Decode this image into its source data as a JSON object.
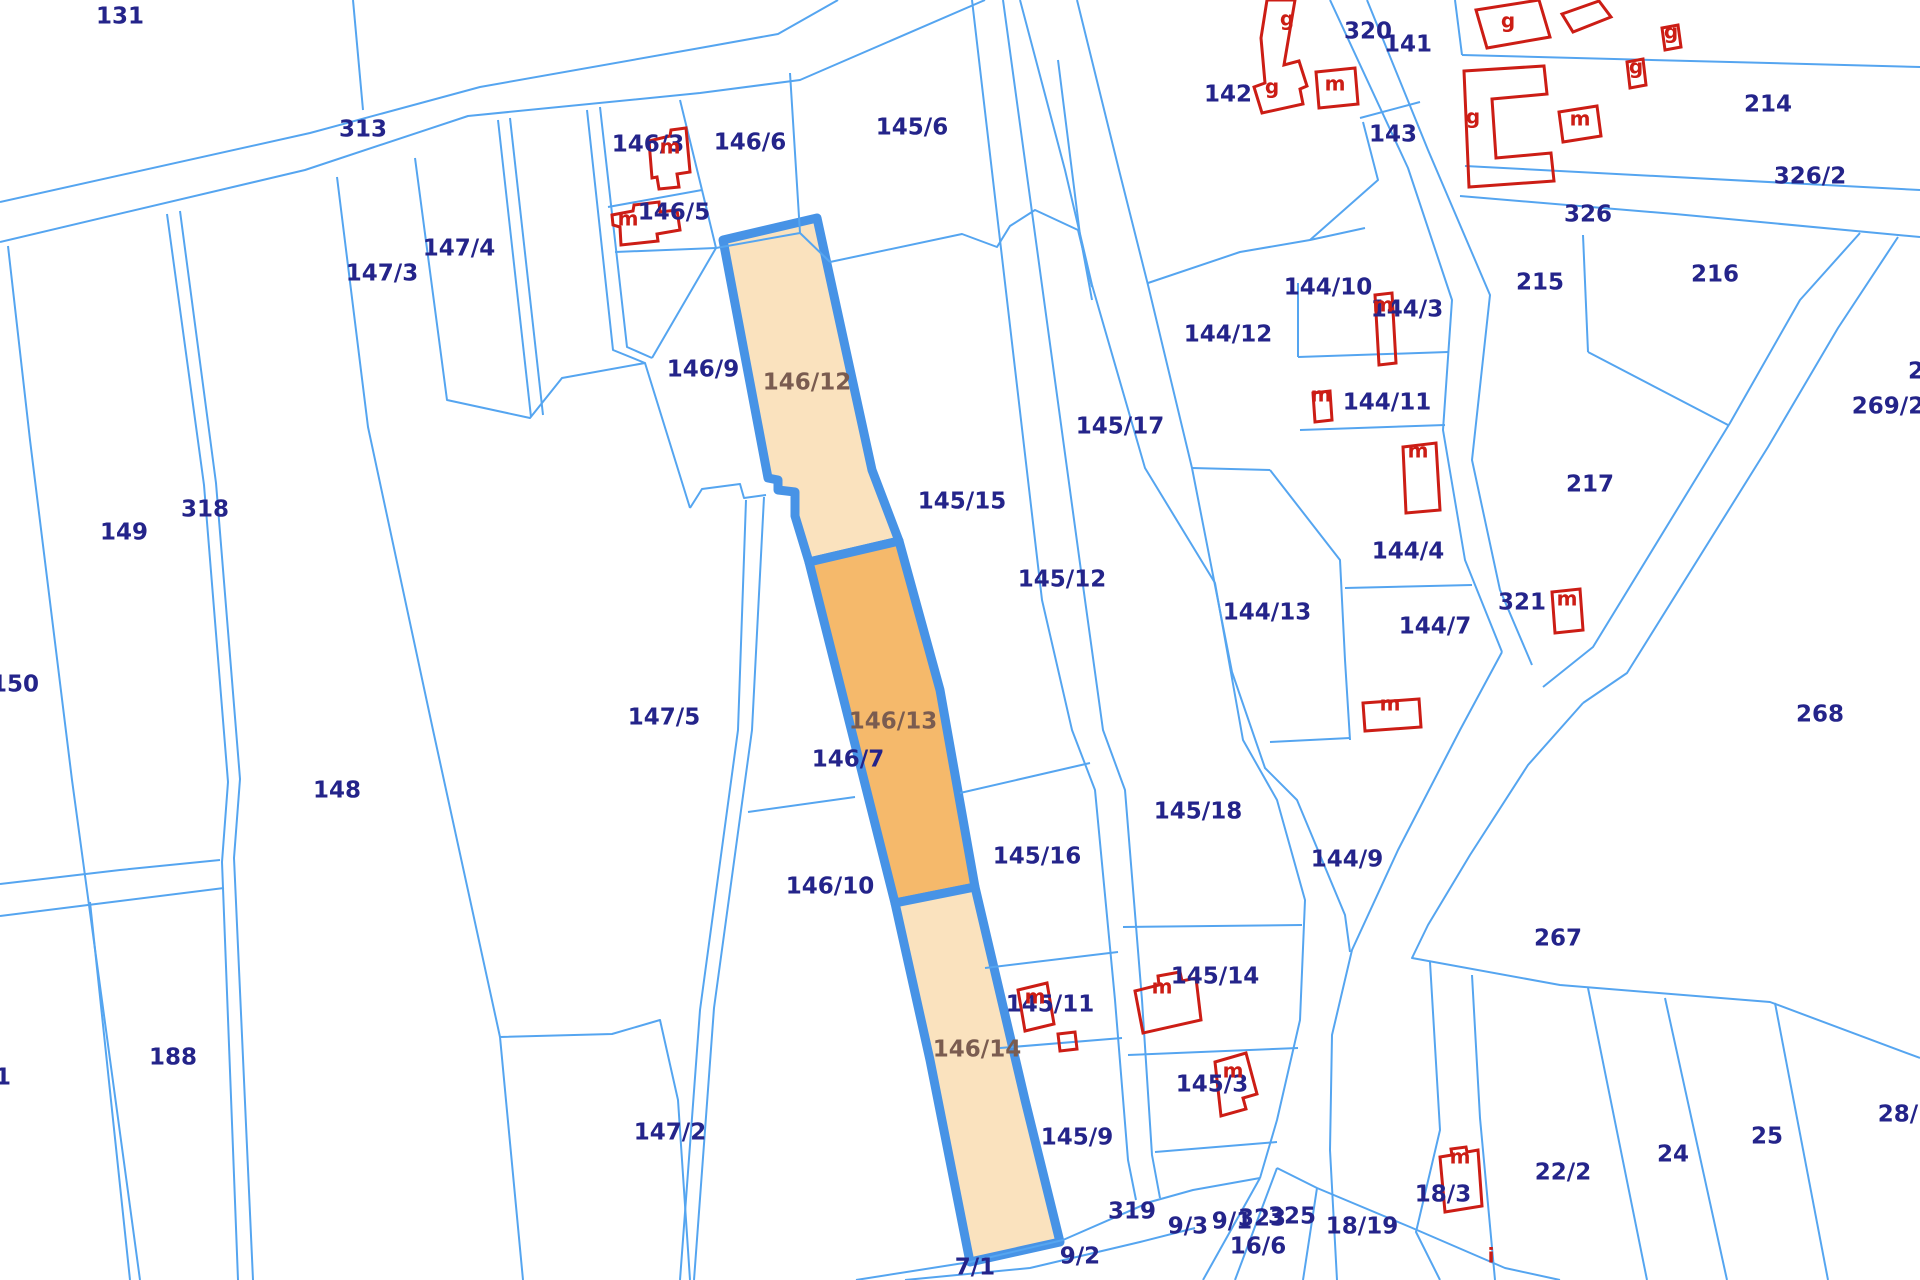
{
  "map": {
    "type": "cadastral-parcel-map",
    "colors": {
      "background": "#ffffff",
      "parcel_line": "#55A5F0",
      "highlight_border": "#4793E6",
      "label_navy": "#24248A",
      "label_highlight": "#7A5C50",
      "building_red": "#CC1D15",
      "fill_light": "#FAE2BE",
      "fill_dark": "#F5B96B"
    },
    "labels": [
      [
        "131",
        120,
        17,
        0
      ],
      [
        "313",
        363,
        130,
        0
      ],
      [
        "146/3",
        648,
        145,
        0
      ],
      [
        "146/6",
        750,
        143,
        0
      ],
      [
        "145/6",
        912,
        128,
        0
      ],
      [
        "146/5",
        674,
        213,
        0
      ],
      [
        "147/4",
        459,
        249,
        0
      ],
      [
        "147/3",
        382,
        274,
        0
      ],
      [
        "142",
        1228,
        95,
        0
      ],
      [
        "320",
        1368,
        32,
        0
      ],
      [
        "141",
        1408,
        45,
        0
      ],
      [
        "143",
        1393,
        135,
        0
      ],
      [
        "214",
        1768,
        105,
        0
      ],
      [
        "326/2",
        1810,
        177,
        0
      ],
      [
        "326",
        1588,
        215,
        0
      ],
      [
        "215",
        1540,
        283,
        0
      ],
      [
        "216",
        1715,
        275,
        0
      ],
      [
        "269/2",
        1888,
        407,
        0
      ],
      [
        "2",
        1916,
        372,
        0
      ],
      [
        "217",
        1590,
        485,
        0
      ],
      [
        "144/10",
        1328,
        288,
        0
      ],
      [
        "144/3",
        1407,
        310,
        0
      ],
      [
        "144/12",
        1228,
        335,
        0
      ],
      [
        "144/11",
        1387,
        403,
        0
      ],
      [
        "145/17",
        1120,
        427,
        0
      ],
      [
        "144/4",
        1408,
        552,
        0
      ],
      [
        "144/13",
        1267,
        613,
        0
      ],
      [
        "144/7",
        1435,
        627,
        0
      ],
      [
        "321",
        1522,
        603,
        0
      ],
      [
        "318",
        205,
        510,
        0
      ],
      [
        "149",
        124,
        533,
        0
      ],
      [
        "150",
        15,
        685,
        0
      ],
      [
        "145/15",
        962,
        502,
        0
      ],
      [
        "146/9",
        703,
        370,
        0
      ],
      [
        "145/12",
        1062,
        580,
        0
      ],
      [
        "147/5",
        664,
        718,
        0
      ],
      [
        "146/7",
        848,
        760,
        0
      ],
      [
        "148",
        337,
        791,
        0
      ],
      [
        "144/9",
        1347,
        860,
        0
      ],
      [
        "145/16",
        1037,
        857,
        0
      ],
      [
        "145/18",
        1198,
        812,
        0
      ],
      [
        "146/10",
        830,
        887,
        0
      ],
      [
        "268",
        1820,
        715,
        0
      ],
      [
        "267",
        1558,
        939,
        0
      ],
      [
        "145/14",
        1215,
        977,
        0
      ],
      [
        "145/11",
        1050,
        1005,
        0
      ],
      [
        "145/3",
        1212,
        1085,
        0
      ],
      [
        "145/9",
        1077,
        1138,
        0
      ],
      [
        "188",
        173,
        1058,
        0
      ],
      [
        "147/2",
        670,
        1133,
        0
      ],
      [
        "1",
        3,
        1078,
        0
      ],
      [
        "28/1",
        1906,
        1115,
        0
      ],
      [
        "22/2",
        1563,
        1173,
        0
      ],
      [
        "24",
        1673,
        1155,
        0
      ],
      [
        "25",
        1767,
        1137,
        0
      ],
      [
        "18/3",
        1443,
        1195,
        0
      ],
      [
        "18/19",
        1362,
        1227,
        0
      ],
      [
        "319",
        1132,
        1212,
        0
      ],
      [
        "9/3",
        1188,
        1227,
        0
      ],
      [
        "9/1",
        1232,
        1222,
        0
      ],
      [
        "323",
        1262,
        1219,
        0
      ],
      [
        "325",
        1292,
        1217,
        0
      ],
      [
        "16/6",
        1258,
        1247,
        0
      ],
      [
        "9/2",
        1080,
        1257,
        0
      ],
      [
        "7/1",
        975,
        1268,
        0
      ],
      [
        "146/12",
        807,
        383,
        1
      ],
      [
        "146/13",
        893,
        722,
        1
      ],
      [
        "146/14",
        977,
        1050,
        1
      ],
      [
        "g",
        1287,
        20,
        2
      ],
      [
        "g",
        1272,
        88,
        2
      ],
      [
        "m",
        1335,
        85,
        2
      ],
      [
        "g",
        1508,
        22,
        2
      ],
      [
        "g",
        1473,
        118,
        2
      ],
      [
        "m",
        1580,
        120,
        2
      ],
      [
        "g",
        1671,
        33,
        2
      ],
      [
        "g",
        1636,
        68,
        2
      ],
      [
        "m",
        1383,
        306,
        2
      ],
      [
        "m",
        1321,
        396,
        2
      ],
      [
        "m",
        1418,
        452,
        2
      ],
      [
        "m",
        1390,
        705,
        2
      ],
      [
        "m",
        1567,
        600,
        2
      ],
      [
        "m",
        1035,
        998,
        2
      ],
      [
        "m",
        1162,
        988,
        2
      ],
      [
        "m",
        1233,
        1072,
        2
      ],
      [
        "m",
        1460,
        1158,
        2
      ],
      [
        "i",
        1491,
        1257,
        2
      ],
      [
        "m",
        670,
        148,
        2
      ],
      [
        "m",
        628,
        220,
        2
      ]
    ],
    "boundary_lines": [
      [
        0,
        202,
        310,
        133,
        480,
        87,
        700,
        48,
        778,
        34,
        838,
        0
      ],
      [
        0,
        242,
        305,
        170,
        468,
        116,
        700,
        93,
        800,
        80,
        985,
        0
      ],
      [
        353,
        0,
        363,
        110
      ],
      [
        8,
        246,
        30,
        440,
        72,
        780,
        140,
        1280
      ],
      [
        167,
        214,
        204,
        485,
        228,
        782,
        222,
        862,
        238,
        1280
      ],
      [
        180,
        211,
        216,
        483,
        240,
        779,
        234,
        858,
        253,
        1280
      ],
      [
        0,
        884,
        120,
        870,
        220,
        860
      ],
      [
        0,
        916,
        120,
        901,
        224,
        888
      ],
      [
        90,
        902,
        130,
        1280
      ],
      [
        337,
        177,
        368,
        427,
        433,
        730,
        500,
        1037,
        523,
        1280
      ],
      [
        500,
        1037,
        612,
        1034,
        660,
        1020,
        678,
        1100,
        690,
        1280
      ],
      [
        415,
        158,
        447,
        400,
        530,
        418,
        562,
        378,
        645,
        363,
        690,
        508
      ],
      [
        690,
        508,
        702,
        489,
        740,
        484,
        744,
        498,
        766,
        495
      ],
      [
        498,
        120,
        531,
        417
      ],
      [
        510,
        118,
        543,
        415
      ],
      [
        587,
        110,
        613,
        350,
        645,
        363
      ],
      [
        600,
        107,
        627,
        347,
        652,
        358
      ],
      [
        716,
        248,
        652,
        358
      ],
      [
        746,
        500,
        738,
        730,
        700,
        1010,
        680,
        1280
      ],
      [
        764,
        497,
        752,
        730,
        714,
        1008,
        694,
        1280
      ],
      [
        680,
        100,
        702,
        190
      ],
      [
        608,
        207,
        702,
        190
      ],
      [
        702,
        190,
        716,
        248
      ],
      [
        615,
        252,
        716,
        248
      ],
      [
        790,
        73,
        800,
        233
      ],
      [
        716,
        248,
        800,
        233
      ],
      [
        800,
        233,
        830,
        262
      ],
      [
        830,
        262,
        962,
        234,
        997,
        247,
        1010,
        226,
        1035,
        210,
        1078,
        230,
        1092,
        287
      ],
      [
        972,
        0,
        1042,
        600,
        1072,
        730,
        1095,
        790,
        1115,
        1000,
        1128,
        1160,
        1136,
        1200
      ],
      [
        1003,
        0,
        1085,
        600,
        1103,
        730,
        1125,
        790,
        1142,
        1000,
        1152,
        1155,
        1160,
        1198
      ],
      [
        1058,
        60,
        1080,
        235,
        1092,
        300
      ],
      [
        1020,
        0,
        1065,
        170,
        1092,
        285,
        1145,
        468,
        1215,
        583,
        1243,
        740,
        1277,
        800,
        1305,
        900,
        1300,
        1020,
        1277,
        1120,
        1260,
        1178
      ],
      [
        1077,
        0,
        1119,
        170,
        1148,
        285,
        1192,
        468,
        1232,
        672,
        1265,
        768,
        1297,
        800,
        1345,
        915,
        1350,
        952
      ],
      [
        1192,
        468,
        1270,
        470
      ],
      [
        1270,
        470,
        1340,
        560,
        1345,
        660,
        1350,
        740
      ],
      [
        1270,
        742,
        1350,
        738
      ],
      [
        1298,
        283,
        1298,
        357
      ],
      [
        1298,
        357,
        1448,
        352
      ],
      [
        1300,
        430,
        1445,
        425
      ],
      [
        1345,
        588,
        1472,
        585
      ],
      [
        1148,
        283,
        1240,
        252,
        1310,
        240,
        1365,
        228
      ],
      [
        1363,
        122,
        1378,
        180,
        1310,
        240
      ],
      [
        1360,
        118,
        1420,
        102
      ],
      [
        1330,
        0,
        1408,
        168,
        1452,
        300,
        1443,
        430,
        1465,
        560,
        1502,
        652
      ],
      [
        1367,
        0,
        1428,
        150,
        1490,
        295,
        1472,
        460,
        1500,
        590,
        1532,
        665
      ],
      [
        1860,
        233,
        1800,
        300,
        1730,
        423,
        1593,
        647,
        1543,
        687
      ],
      [
        1898,
        237,
        1838,
        328,
        1768,
        447,
        1627,
        673,
        1583,
        703
      ],
      [
        1502,
        652,
        1460,
        730,
        1398,
        850,
        1352,
        950,
        1332,
        1035,
        1330,
        1150,
        1337,
        1280
      ],
      [
        1583,
        703,
        1528,
        765,
        1470,
        855,
        1428,
        925,
        1412,
        958,
        1560,
        985,
        1770,
        1002,
        1920,
        1058
      ],
      [
        1462,
        55,
        1920,
        67
      ],
      [
        1462,
        55,
        1455,
        0
      ],
      [
        1465,
        166,
        1920,
        190
      ],
      [
        1460,
        196,
        1675,
        214,
        1877,
        233,
        1920,
        237
      ],
      [
        1583,
        235,
        1588,
        352
      ],
      [
        1588,
        352,
        1728,
        425
      ],
      [
        1472,
        975,
        1480,
        1118,
        1495,
        1280
      ],
      [
        1588,
        988,
        1647,
        1280
      ],
      [
        1665,
        998,
        1727,
        1280
      ],
      [
        1775,
        1003,
        1828,
        1280
      ],
      [
        1430,
        962,
        1440,
        1130,
        1416,
        1232,
        1440,
        1280
      ],
      [
        1277,
        1168,
        1317,
        1188,
        1410,
        1227,
        1505,
        1268,
        1560,
        1280
      ],
      [
        1260,
        1178,
        1203,
        1280
      ],
      [
        1277,
        1168,
        1235,
        1280
      ],
      [
        1317,
        1188,
        1303,
        1280
      ],
      [
        856,
        1280,
        970,
        1262,
        1063,
        1240,
        1150,
        1202,
        1193,
        1190,
        1260,
        1178
      ],
      [
        905,
        1280,
        1030,
        1268,
        1140,
        1242,
        1195,
        1228
      ],
      [
        1155,
        1152,
        1277,
        1142
      ],
      [
        985,
        968,
        1118,
        952
      ],
      [
        1000,
        1048,
        1122,
        1038
      ],
      [
        1123,
        927,
        1302,
        925
      ],
      [
        1128,
        1055,
        1298,
        1048
      ],
      [
        960,
        793,
        1090,
        763
      ],
      [
        748,
        812,
        855,
        797
      ]
    ],
    "highlighted_parcels": [
      {
        "id": "146/12",
        "shade": "light",
        "points": [
          723,
          240,
          817,
          218,
          872,
          470,
          899,
          541,
          809,
          562,
          795,
          516,
          795,
          492,
          778,
          490,
          778,
          480,
          768,
          478
        ]
      },
      {
        "id": "146/13",
        "shade": "dark",
        "points": [
          809,
          562,
          899,
          541,
          940,
          690,
          975,
          887,
          895,
          903
        ]
      },
      {
        "id": "146/14",
        "shade": "light",
        "points": [
          895,
          903,
          975,
          887,
          1025,
          1100,
          1060,
          1242,
          970,
          1262,
          930,
          1060
        ]
      }
    ],
    "buildings": [
      [
        649,
        141,
        670,
        136,
        671,
        130,
        686,
        128,
        690,
        172,
        677,
        174,
        679,
        187,
        659,
        189,
        657,
        177,
        652,
        178
      ],
      [
        613,
        225,
        612,
        215,
        633,
        211,
        634,
        205,
        659,
        202,
        660,
        212,
        677,
        210,
        680,
        230,
        657,
        234,
        658,
        241,
        621,
        245,
        620,
        227
      ],
      [
        1267,
        0,
        1295,
        0,
        1284,
        65,
        1299,
        61,
        1307,
        86,
        1300,
        89,
        1303,
        104,
        1262,
        113,
        1254,
        87,
        1265,
        83,
        1261,
        38
      ],
      [
        1316,
        72,
        1355,
        68,
        1358,
        104,
        1319,
        108
      ],
      [
        1375,
        295,
        1392,
        293,
        1396,
        363,
        1379,
        365
      ],
      [
        1313,
        393,
        1330,
        391,
        1332,
        420,
        1315,
        422
      ],
      [
        1403,
        447,
        1436,
        443,
        1440,
        510,
        1406,
        513
      ],
      [
        1363,
        703,
        1419,
        699,
        1421,
        727,
        1365,
        731
      ],
      [
        1552,
        592,
        1580,
        589,
        1583,
        630,
        1555,
        633
      ],
      [
        1018,
        990,
        1047,
        983,
        1054,
        1024,
        1025,
        1031
      ],
      [
        1058,
        1034,
        1075,
        1032,
        1077,
        1049,
        1060,
        1051
      ],
      [
        1135,
        991,
        1159,
        985,
        1158,
        976,
        1180,
        972,
        1182,
        981,
        1196,
        978,
        1201,
        1020,
        1143,
        1033
      ],
      [
        1215,
        1062,
        1246,
        1053,
        1257,
        1094,
        1243,
        1098,
        1246,
        1109,
        1221,
        1116
      ],
      [
        1440,
        1157,
        1452,
        1155,
        1451,
        1149,
        1466,
        1147,
        1467,
        1152,
        1478,
        1150,
        1482,
        1206,
        1445,
        1212
      ],
      [
        1562,
        14,
        1599,
        1,
        1611,
        17,
        1573,
        32
      ],
      [
        1476,
        10,
        1539,
        0,
        1550,
        37,
        1487,
        48
      ],
      [
        1662,
        28,
        1678,
        25,
        1681,
        47,
        1665,
        50
      ],
      [
        1627,
        62,
        1643,
        59,
        1646,
        85,
        1630,
        88
      ],
      [
        1464,
        71,
        1544,
        66,
        1547,
        94,
        1492,
        99,
        1496,
        158,
        1551,
        153,
        1554,
        181,
        1469,
        187
      ],
      [
        1559,
        112,
        1597,
        106,
        1601,
        136,
        1563,
        142
      ]
    ]
  }
}
